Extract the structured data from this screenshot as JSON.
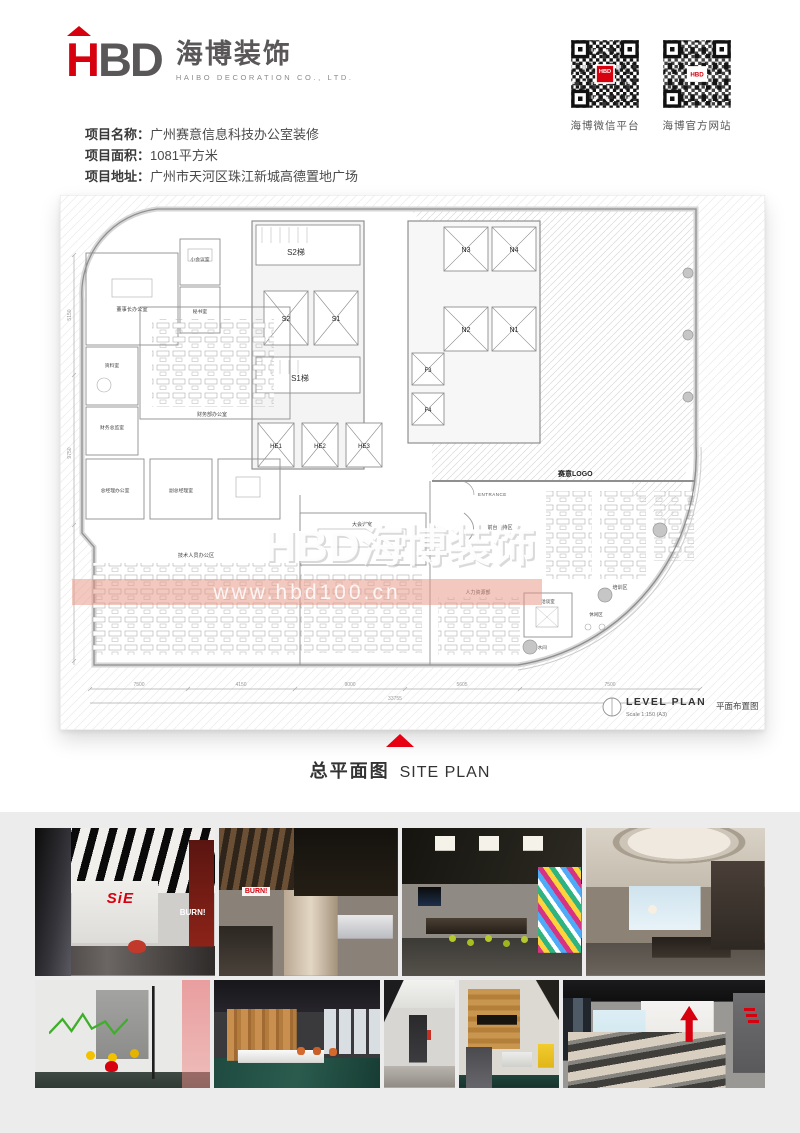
{
  "colors": {
    "accent_red": "#d7000f",
    "logo_gray": "#595757",
    "footer_bg": "#ececec",
    "triangle_red": "#e60012"
  },
  "header": {
    "logo_h": "H",
    "logo_bd": "BD",
    "logo_cn": "海博装饰",
    "logo_en": "HAIBO DECORATION CO., LTD.",
    "qr_left": {
      "label": "海博微信平台",
      "center_text": "HBD"
    },
    "qr_right": {
      "label": "海博官方网站",
      "center_text": "HBD"
    }
  },
  "project": {
    "name_label": "项目名称：",
    "name_value": "广州赛意信息科技办公室装修",
    "area_label": "项目面积：",
    "area_value": "1081平方米",
    "addr_label": "项目地址：",
    "addr_value": "广州市天河区珠江新城高德置地广场"
  },
  "plan": {
    "watermark_main": "HBD海博装饰",
    "watermark_sub": "www.hbd100.cn",
    "stair_s2": "S2梯",
    "stair_s1": "S1梯",
    "elev": {
      "s2": "S2",
      "s1": "S1",
      "n3": "N3",
      "n4": "N4",
      "n2": "N2",
      "n1": "N1",
      "f3": "F3",
      "f4": "F4",
      "he1": "HE1",
      "he2": "HE2",
      "he3": "HE3"
    },
    "rooms": {
      "chairman": "董事长办公室",
      "small_meeting": "小会议室",
      "secretary": "秘书室",
      "archive": "资料室",
      "cfo": "财务总监室",
      "finance": "财务部办公室",
      "gm": "总经理办公室",
      "vgm": "副总经理室",
      "meeting": "大会议室",
      "tech": "技术人员办公区",
      "reception": "前台接待区",
      "hr": "人力资源部",
      "training": "培训区",
      "talk": "洽谈室",
      "lounge": "休闲区",
      "pantry": "茶水间"
    },
    "logo_label": "赛意LOGO",
    "entrance": "ENTRANCE",
    "dims": {
      "d1": "7500",
      "d2": "4150",
      "d3": "9000",
      "d4": "5605",
      "d5": "7500",
      "total": "33755",
      "v1": "5150",
      "v2": "9750"
    },
    "titleblock": {
      "title": "LEVEL  PLAN",
      "scale": "Scale   1:150 (A3)",
      "name_cn": "平面布置图"
    }
  },
  "caption": {
    "zh": "总平面图",
    "en": "SITE PLAN"
  },
  "gallery": {
    "sie": "SiE",
    "burn": "BURN!"
  }
}
